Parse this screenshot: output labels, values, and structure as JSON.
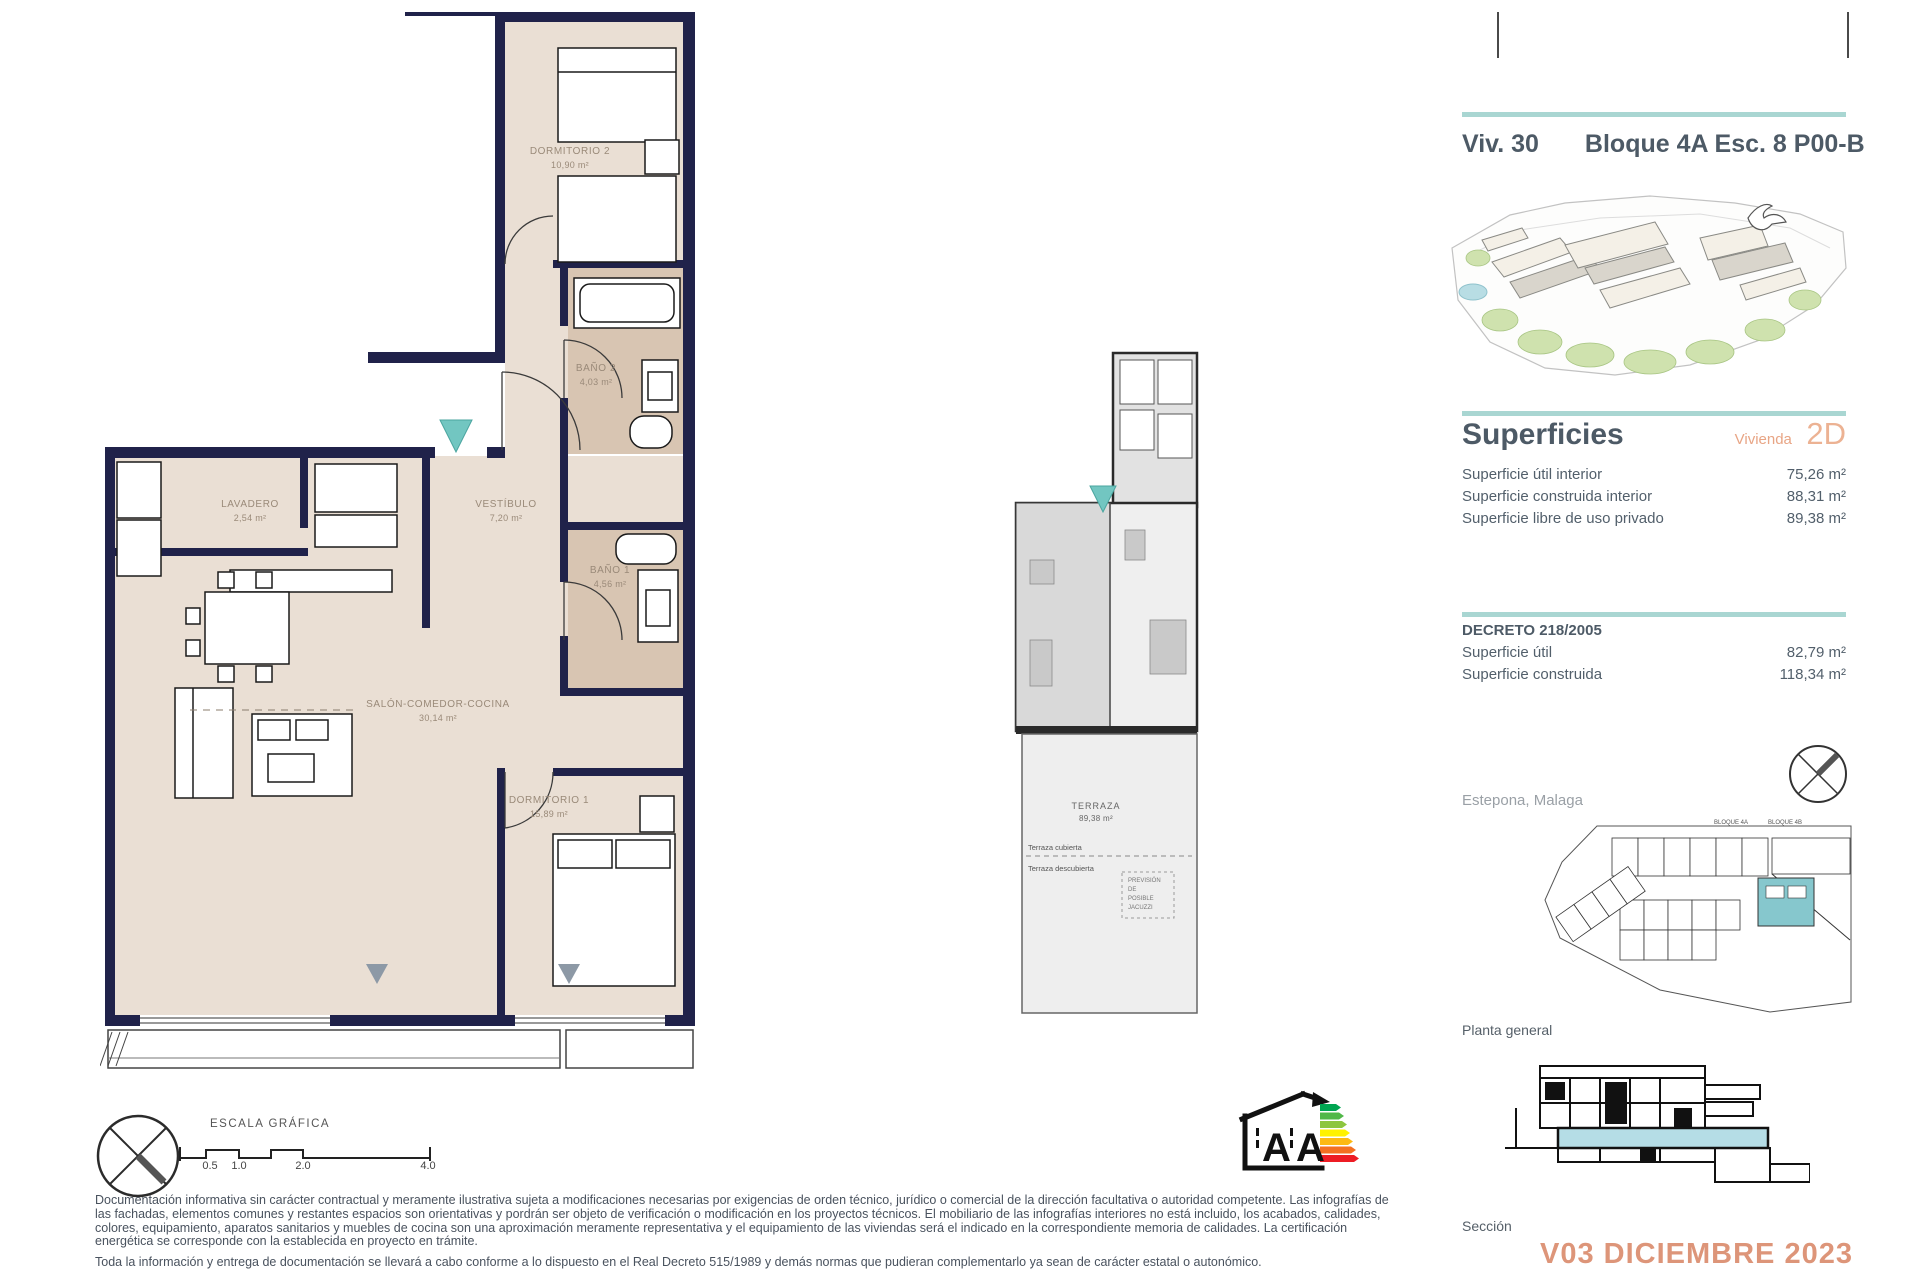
{
  "header": {
    "unit": "Viv. 30",
    "block_line": "Bloque 4A Esc. 8 P00-B"
  },
  "superficies": {
    "title": "Superficies",
    "vivienda_label": "Vivienda",
    "vivienda_type": "2D",
    "rows": [
      {
        "label": "Superficie útil interior",
        "value": "75,26 m²"
      },
      {
        "label": "Superficie construida interior",
        "value": "88,31 m²"
      },
      {
        "label": "Superficie libre de uso privado",
        "value": "89,38 m²"
      }
    ]
  },
  "decreto": {
    "title": "DECRETO 218/2005",
    "rows": [
      {
        "label": "Superficie útil",
        "value": "82,79 m²"
      },
      {
        "label": "Superficie construida",
        "value": "118,34 m²"
      }
    ]
  },
  "location": "Estepona, Malaga",
  "labels": {
    "planta_general": "Planta general",
    "seccion": "Sección"
  },
  "version": "V03 DICIEMBRE 2023",
  "floorplan": {
    "rooms": [
      {
        "name": "DORMITORIO 2",
        "area": "10,90 m²"
      },
      {
        "name": "BAÑO 2",
        "area": "4,03 m²"
      },
      {
        "name": "VESTÍBULO",
        "area": "7,20 m²"
      },
      {
        "name": "LAVADERO",
        "area": "2,54 m²"
      },
      {
        "name": "BAÑO 1",
        "area": "4,56 m²"
      },
      {
        "name": "SALÓN-COMEDOR-COCINA",
        "area": "30,14 m²"
      },
      {
        "name": "DORMITORIO 1",
        "area": "15,89 m²"
      }
    ]
  },
  "keyplan": {
    "terraza_name": "TERRAZA",
    "terraza_area": "89,38 m²",
    "cubierta": "Terraza cubierta",
    "descubierta": "Terraza descubierta",
    "jacuzzi_note": "PREVISIÓN\nDE\nPOSIBLE\nJACUZZI"
  },
  "siteplan": {
    "bloque_a": "BLOQUE 4A",
    "bloque_b": "BLOQUE 4B"
  },
  "scale_bar": {
    "title": "ESCALA GRÁFICA",
    "ticks": [
      "0.5",
      "1.0",
      "2.0",
      "4.0"
    ]
  },
  "energy": {
    "letters": [
      "A",
      "A"
    ]
  },
  "disclaimer": {
    "p1": "Documentación informativa sin carácter contractual y meramente ilustrativa sujeta a modificaciones necesarias por exigencias de orden técnico, jurídico o comercial de la dirección facultativa o autoridad competente. Las infografías de las fachadas, elementos comunes y restantes espacios son orientativas y pordrán ser objeto de verificación o modificación en los proyectos técnicos. El mobiliario de las infografías interiores no está incluido, los acabados, calidades, colores, equipamiento, aparatos sanitarios y muebles de cocina son una aproximación meramente representativa y el equipamiento de las viviendas será el indicado en la correspondiente memoria de calidades. La certificación energética se corresponde con la establecida en proyecto en trámite.",
    "p2": "Toda la información y entrega de documentación se llevará a cabo conforme a lo dispuesto en el Real Decreto 515/1989 y demás normas que pudieran complementarlo ya sean de carácter estatal o autonómico."
  },
  "colors": {
    "accent_teal": "#a9d6d2",
    "salmon": "#dd9579",
    "wall_navy": "#20224a",
    "floor_beige": "#eadfd4",
    "bath_tan": "#d8c5b2",
    "pool_blue": "#b5dde6",
    "unit_teal": "#86c7cd"
  }
}
